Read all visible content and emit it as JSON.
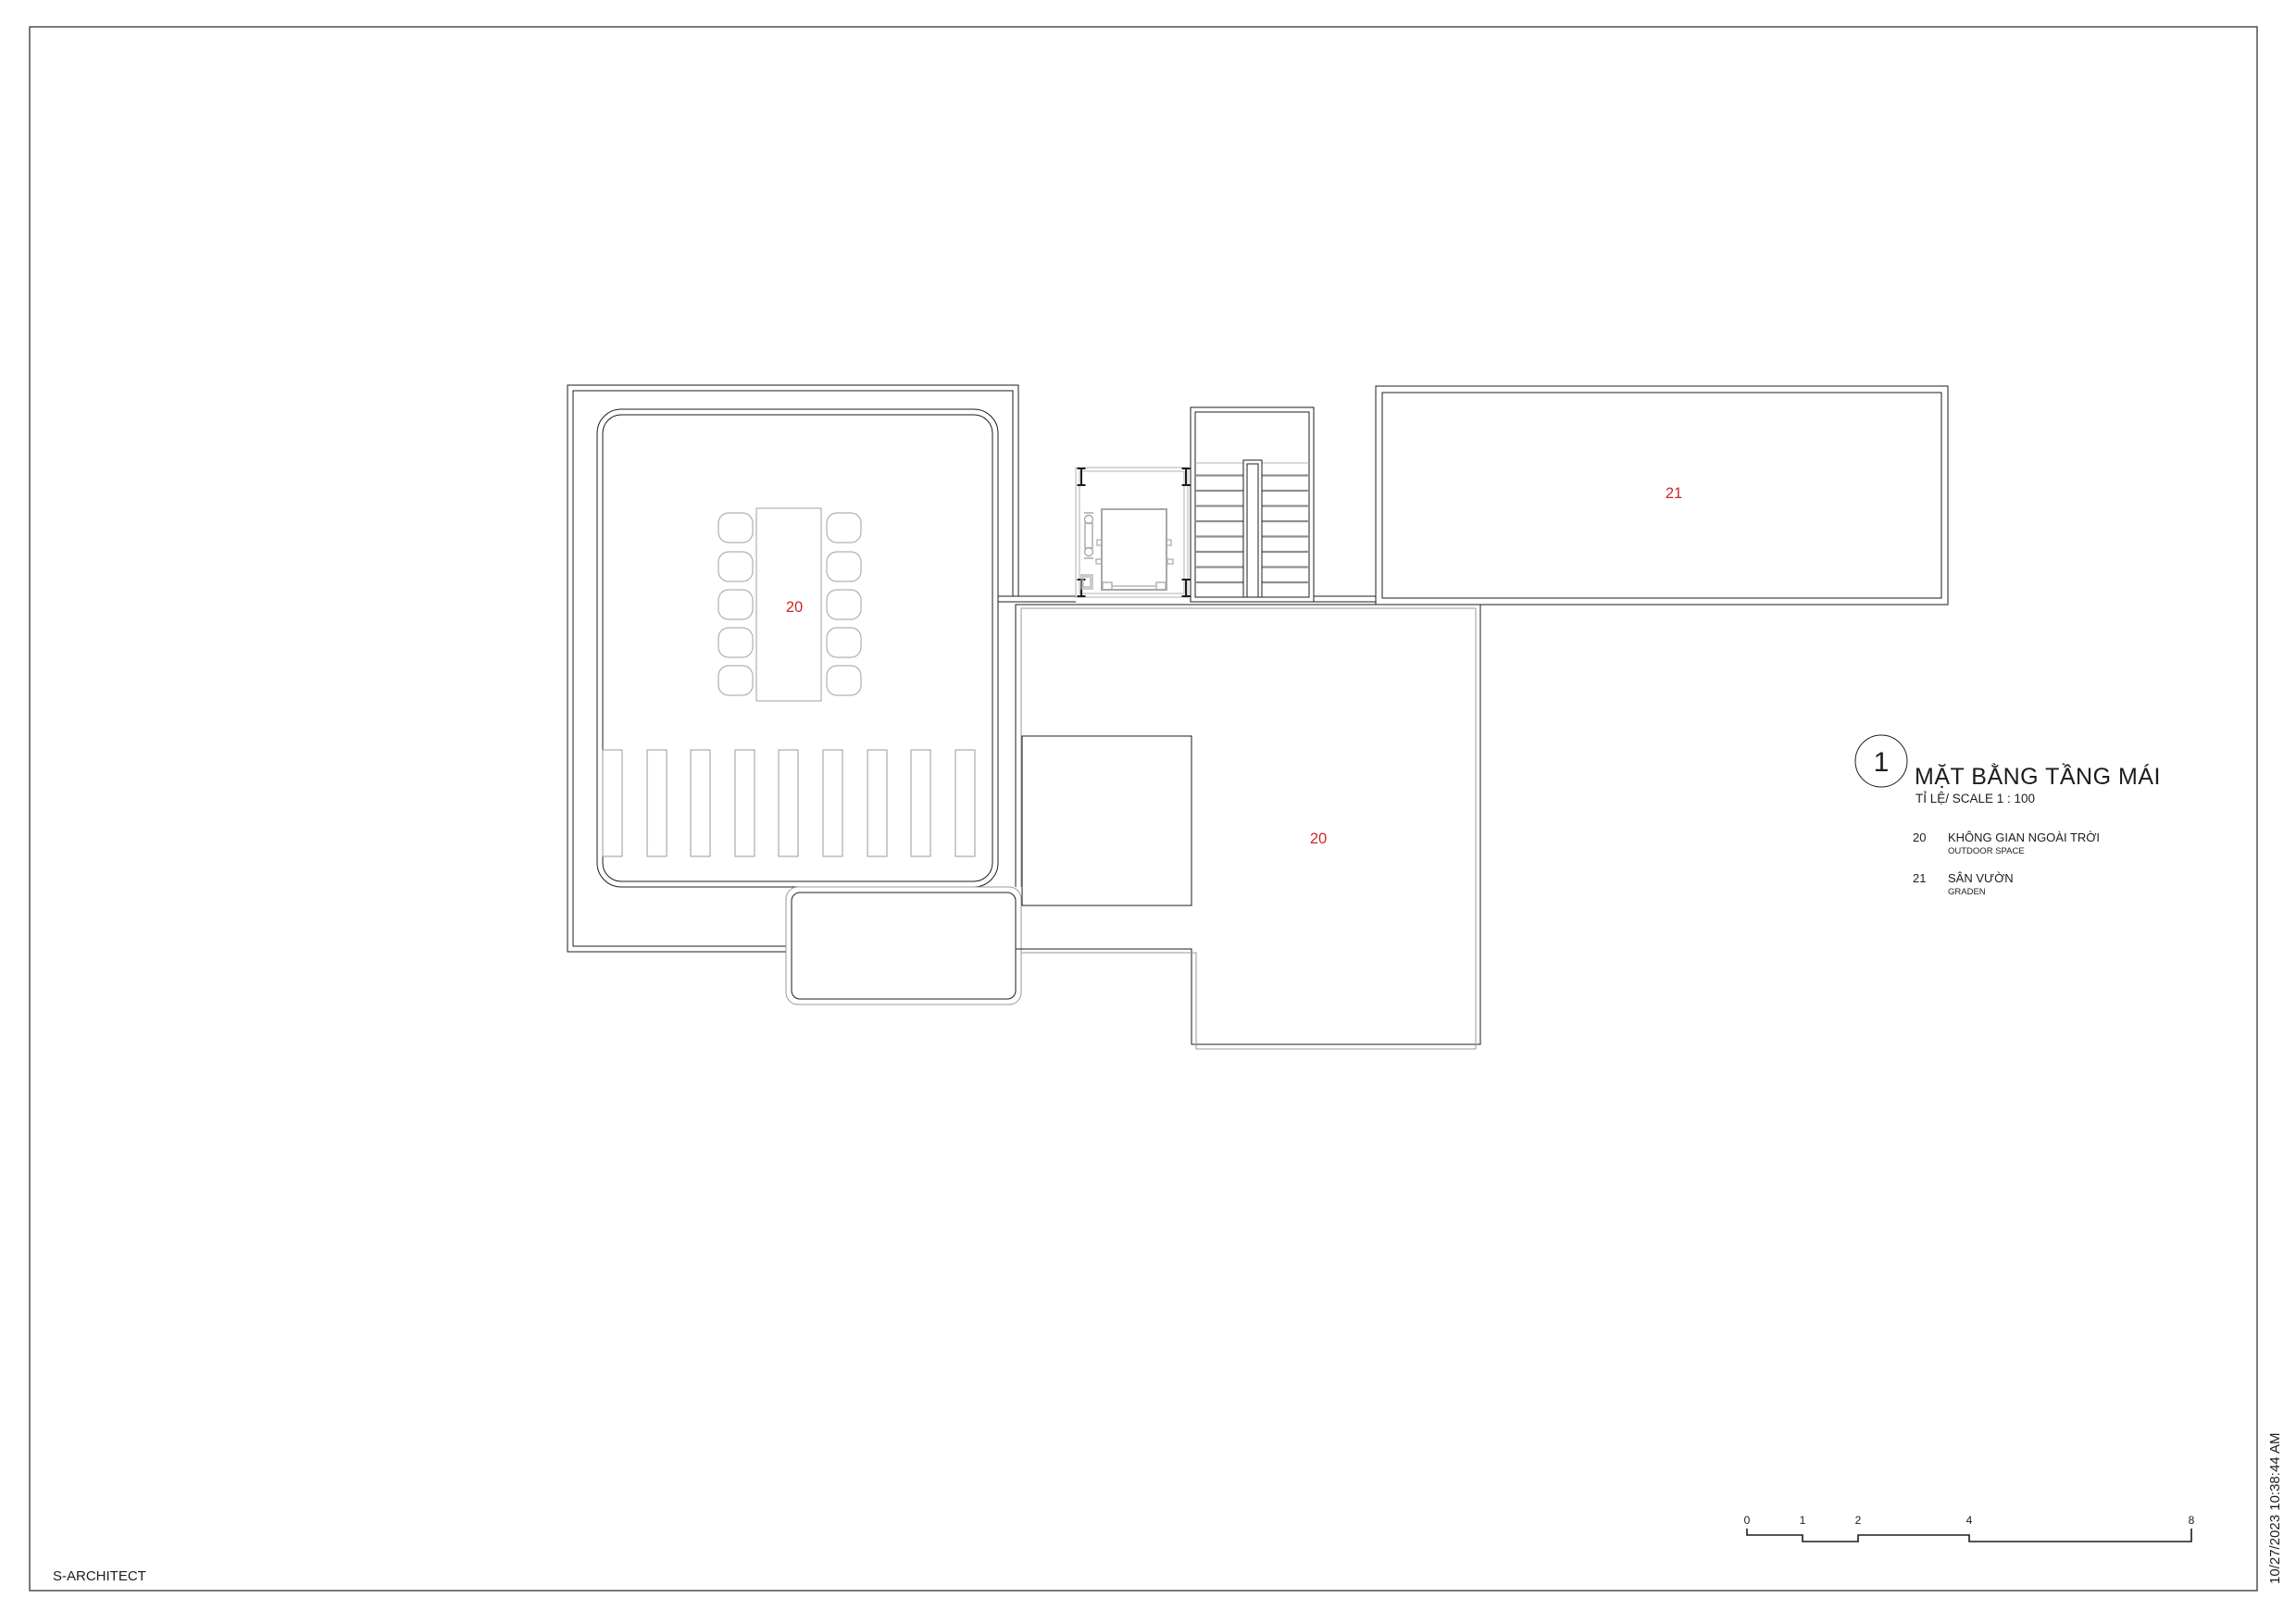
{
  "sheet": {
    "company": "S-ARCHITECT",
    "plot_timestamp": "10/27/2023 10:38:44 AM"
  },
  "title_block": {
    "detail_number": "1",
    "title": "MẶT BẰNG TẦNG MÁI",
    "scale_label": "TỈ LỆ/ SCALE  1 : 100",
    "legend": [
      {
        "code": "20",
        "name_vi": "KHÔNG GIAN NGOÀI TRỜI",
        "name_en": "OUTDOOR SPACE"
      },
      {
        "code": "21",
        "name_vi": "SÂN VƯỜN",
        "name_en": "GRADEN"
      }
    ]
  },
  "plan": {
    "labels": [
      {
        "text": "20",
        "area": "outdoor-space-room"
      },
      {
        "text": "20",
        "area": "outdoor-space-terrace"
      },
      {
        "text": "21",
        "area": "garden"
      }
    ]
  },
  "scale_bar": {
    "ticks": [
      "0",
      "1",
      "2",
      "4",
      "8"
    ]
  },
  "colors": {
    "label_red": "#ce2727",
    "line_black": "#1c1c1c",
    "line_gray": "#9a9a9a",
    "furniture_gray": "#b0b0b0",
    "border_gray": "#4f4f4f",
    "paper": "#ffffff"
  }
}
